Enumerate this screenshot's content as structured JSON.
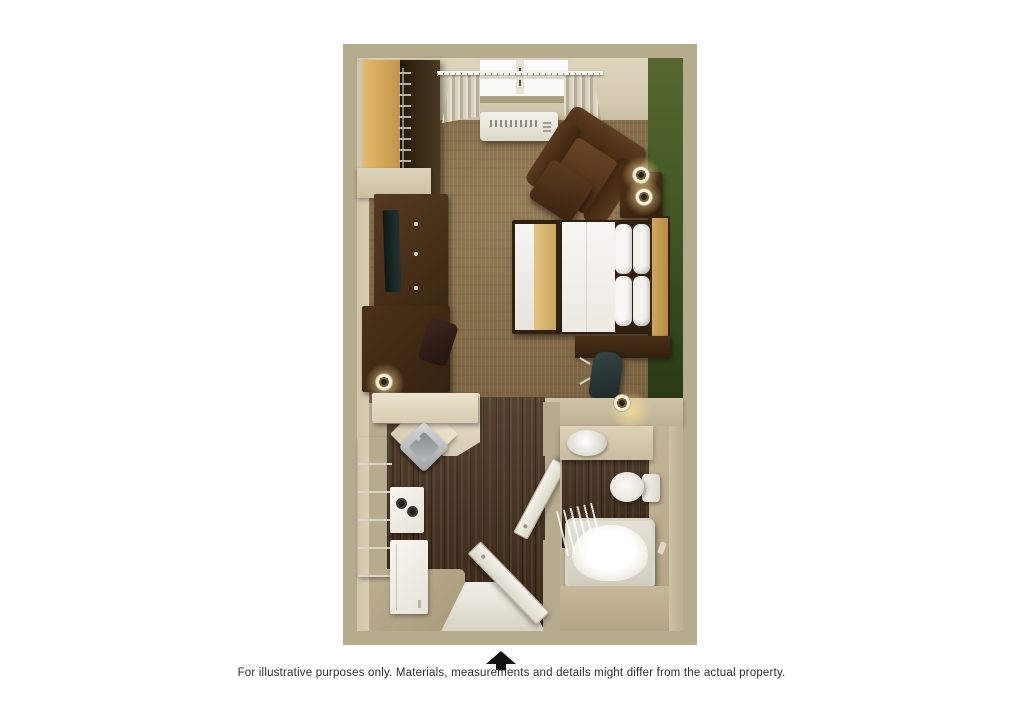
{
  "footer": {
    "text": "For illustrative purposes only.  Materials, measurements and details might differ from the actual property.",
    "arrow_icon": "up-arrow"
  },
  "floor_plan": {
    "description": "3D top-down rendering of a studio suite floor plan",
    "rooms": [
      "bedroom-living-area",
      "kitchenette",
      "hallway",
      "bathroom"
    ],
    "fixtures": [
      "closet-shelf",
      "hanger-rod",
      "tv-dresser",
      "tv",
      "dresser",
      "window",
      "curtains",
      "curtain-rod",
      "ac-unit",
      "armchair",
      "ottoman",
      "side-table",
      "table-lamp",
      "bed",
      "pillows",
      "headboard",
      "desk",
      "desk-chair",
      "desk-lamp",
      "kitchen-counter",
      "kitchen-sink",
      "stove",
      "refrigerator-cabinets",
      "dishwasher",
      "entry-door",
      "entry-threshold",
      "bathroom-door",
      "bathroom-vanity",
      "bathroom-sink",
      "toilet",
      "bathtub",
      "shower-curtain",
      "towel-hook"
    ]
  },
  "colors": {
    "page_bg": "#ffffff",
    "wall_tan": "#b5ac8e",
    "wall_face": "#d8cfb6",
    "green_wall": "#3f5323",
    "carpet": "#8a6f46",
    "wood": "#46301c",
    "cream_counter": "#ded5bf",
    "white_fixture": "#f2f0e9",
    "furniture_brown": "#47301b",
    "bed_gold": "#d8b971",
    "headboard_gold": "#c49a52",
    "entry_beige": "#b3a385",
    "caption_color": "#2b2b2b",
    "arrow_black": "#111111"
  }
}
